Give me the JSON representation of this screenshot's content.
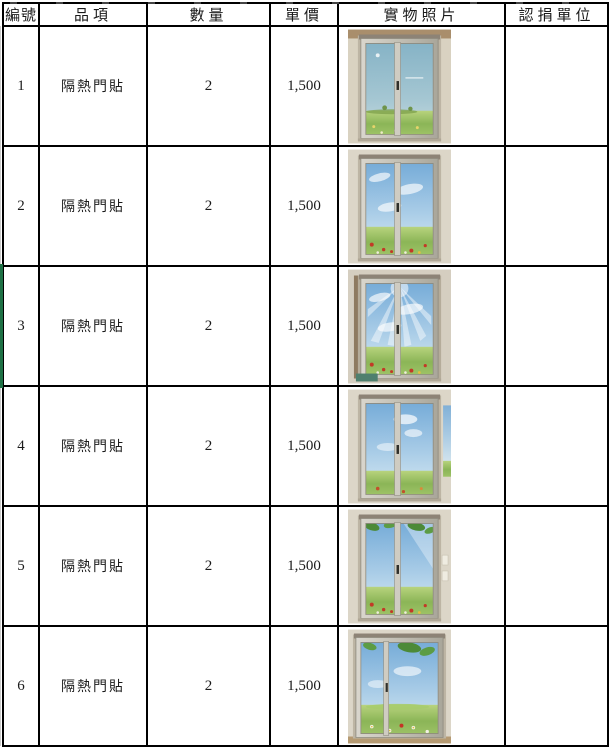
{
  "document": {
    "type": "donation-items-table",
    "language": "zh-TW"
  },
  "table": {
    "headers": {
      "no": "編號",
      "item": "品項",
      "qty": "數量",
      "price": "單價",
      "photo": "實物照片",
      "donor": "認捐單位"
    },
    "rows": [
      {
        "no": "1",
        "item": "隔熱門貼",
        "qty": "2",
        "price": "1,500",
        "donor": "",
        "photo": "玻璃滑門隔熱貼-藍天草原圖案"
      },
      {
        "no": "2",
        "item": "隔熱門貼",
        "qty": "2",
        "price": "1,500",
        "donor": "",
        "photo": "玻璃滑門隔熱貼-藍天白雲紅花花田圖案"
      },
      {
        "no": "3",
        "item": "隔熱門貼",
        "qty": "2",
        "price": "1,500",
        "donor": "",
        "photo": "玻璃滑門隔熱貼-陽光光芒花田圖案"
      },
      {
        "no": "4",
        "item": "隔熱門貼",
        "qty": "2",
        "price": "1,500",
        "donor": "",
        "photo": "玻璃滑門隔熱貼-藍天綠草地圖案"
      },
      {
        "no": "5",
        "item": "隔熱門貼",
        "qty": "2",
        "price": "1,500",
        "donor": "",
        "photo": "玻璃滑門隔熱貼-綠葉藍天花田圖案"
      },
      {
        "no": "6",
        "item": "隔熱門貼",
        "qty": "2",
        "price": "1,500",
        "donor": "",
        "photo": "寬玻璃滑門隔熱貼-綠葉草原雛菊圖案"
      }
    ]
  },
  "colors": {
    "border": "#000000",
    "selection_green": "#1e7145",
    "wall": "#dbd5c7",
    "sky": "#79aeda",
    "grass": "#8bb557"
  }
}
